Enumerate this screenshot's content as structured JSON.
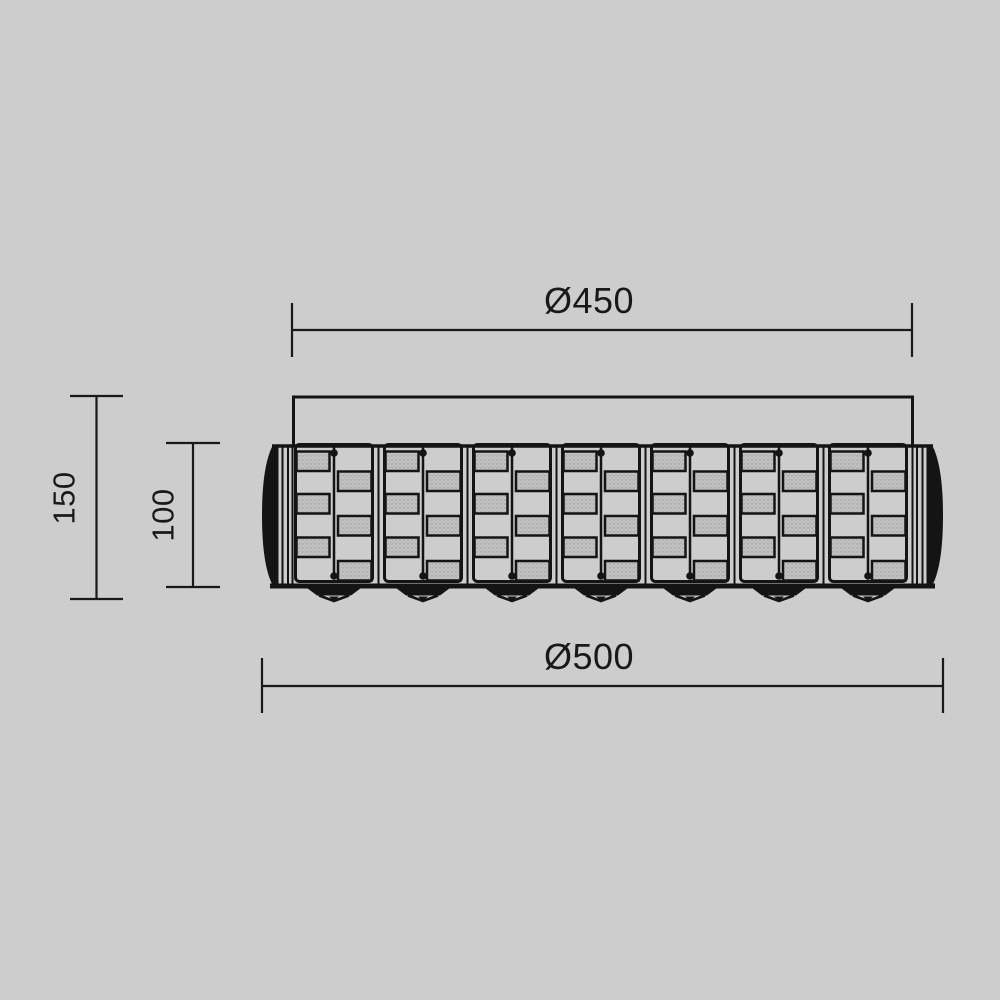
{
  "page": {
    "background_color": "#cdcdcd",
    "line_color": "#141414"
  },
  "drawing": {
    "kind": "technical-dimension-drawing",
    "subject": "crystal-ceiling-lamp-front-view",
    "panel_count": 7,
    "dimensions": {
      "canopy_diameter": {
        "label": "Ø450",
        "value": 450
      },
      "body_diameter": {
        "label": "Ø500",
        "value": 500
      },
      "overall_height": {
        "label": "150",
        "value": 150
      },
      "body_height": {
        "label": "100",
        "value": 100
      }
    }
  }
}
